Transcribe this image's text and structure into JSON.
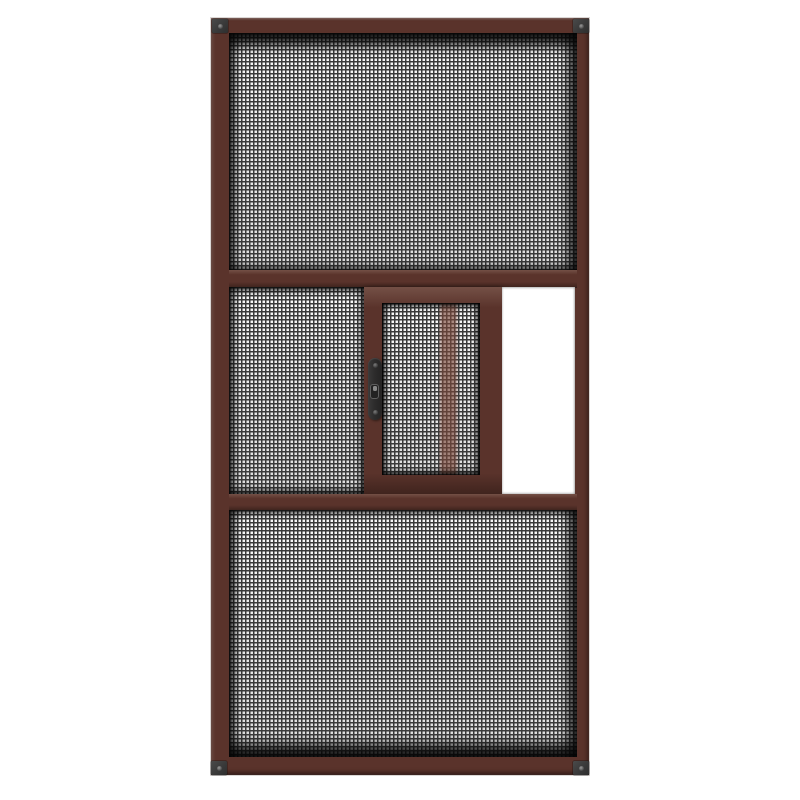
{
  "product": {
    "type": "product render",
    "description": "Brown aluminium sliding insect screen door with three mesh sections, small sliding mesh sash with black handle, open slider gap and black corner caps",
    "background": "plain white"
  },
  "colors": {
    "page_white": "#ffffff",
    "frame_brown": "#5a332b",
    "frame_highlight": "#745046",
    "frame_shadow": "#40241e",
    "mesh_line": "#3a3a3a",
    "mesh_cell": "#efefef",
    "recess_black": "#161616",
    "cap_gray": "#3c3c3c",
    "handle_black": "#2d2c2c",
    "open_gap_white": "#ffffff",
    "overlap_tint": "#7a4638"
  },
  "parts": {
    "frame": "screen door outer frame",
    "top_panel": "top fixed mesh panel",
    "upper_rail": "upper horizontal rail",
    "fixed_mid_panel": "middle fixed mesh panel",
    "sliding_sash": "sliding mesh sash",
    "sash_mesh": "sliding sash mesh",
    "sash_tint": "frame member seen through sash mesh",
    "handle": "sash pull handle",
    "handle_latch": "handle latch keeper",
    "open_gap": "open slider gap",
    "lower_rail": "lower horizontal rail",
    "bottom_panel": "bottom fixed mesh panel",
    "corner_cap": "corner cap with screw"
  },
  "hardware": {
    "corner_cap_count": 4,
    "handle_screw_count": 2
  }
}
